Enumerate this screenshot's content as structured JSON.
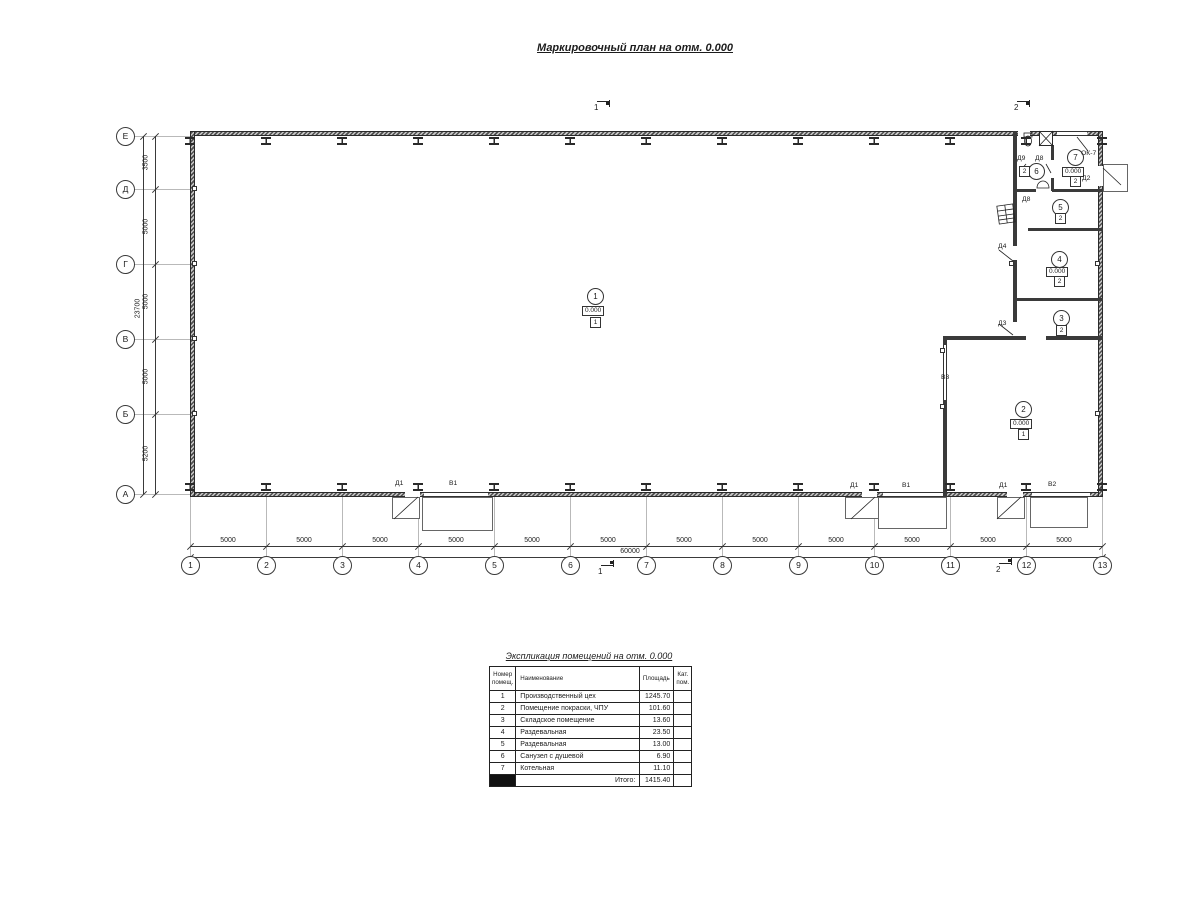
{
  "title": "Маркировочный план на отм. 0.000",
  "plan": {
    "axis_cols": [
      "1",
      "2",
      "3",
      "4",
      "5",
      "6",
      "7",
      "8",
      "9",
      "10",
      "11",
      "12",
      "13"
    ],
    "axis_rows": [
      "Е",
      "Д",
      "Г",
      "В",
      "Б",
      "А"
    ],
    "dim_bottom_segments": [
      "5000",
      "5000",
      "5000",
      "5000",
      "5000",
      "5000",
      "5000",
      "5000",
      "5000",
      "5000",
      "5000",
      "5000"
    ],
    "dim_bottom_total": "60000",
    "dim_left_segments": [
      "3500",
      "5000",
      "5000",
      "5000",
      "5200"
    ],
    "dim_left_total": "23700",
    "section_marks": [
      "1",
      "2",
      "1",
      "2"
    ],
    "rooms": [
      {
        "num": "1",
        "elev": "0.000",
        "cat": "1"
      },
      {
        "num": "2",
        "elev": "0.000",
        "cat": "1"
      },
      {
        "num": "3",
        "elev": null,
        "cat": "2"
      },
      {
        "num": "4",
        "elev": "0.000",
        "cat": "2"
      },
      {
        "num": "5",
        "elev": null,
        "cat": "2"
      },
      {
        "num": "6",
        "elev": null,
        "cat": "2"
      },
      {
        "num": "7",
        "elev": "0.000",
        "cat": "2"
      }
    ],
    "opening_labels": [
      "Д1",
      "В1",
      "Д1",
      "В1",
      "Д1",
      "В2",
      "Д2",
      "Д3",
      "Д4",
      "Д9",
      "Д8",
      "Д8",
      "В3",
      "ОК-7"
    ]
  },
  "schedule": {
    "title": "Экспликация помещений на отм. 0.000",
    "headers": {
      "num": "Номер помещ.",
      "name": "Наименование",
      "area": "Площадь",
      "cat": "Кат. пом."
    },
    "rows": [
      {
        "num": "1",
        "name": "Производственный цех",
        "area": "1245.70",
        "cat": ""
      },
      {
        "num": "2",
        "name": "Помещение покраски, ЧПУ",
        "area": "101.60",
        "cat": ""
      },
      {
        "num": "3",
        "name": "Складское помещение",
        "area": "13.60",
        "cat": ""
      },
      {
        "num": "4",
        "name": "Раздевальная",
        "area": "23.50",
        "cat": ""
      },
      {
        "num": "5",
        "name": "Раздевальная",
        "area": "13.00",
        "cat": ""
      },
      {
        "num": "6",
        "name": "Санузел с душевой",
        "area": "6.90",
        "cat": ""
      },
      {
        "num": "7",
        "name": "Котельная",
        "area": "11.10",
        "cat": ""
      }
    ],
    "total_label": "Итого:",
    "total_value": "1415.40"
  }
}
